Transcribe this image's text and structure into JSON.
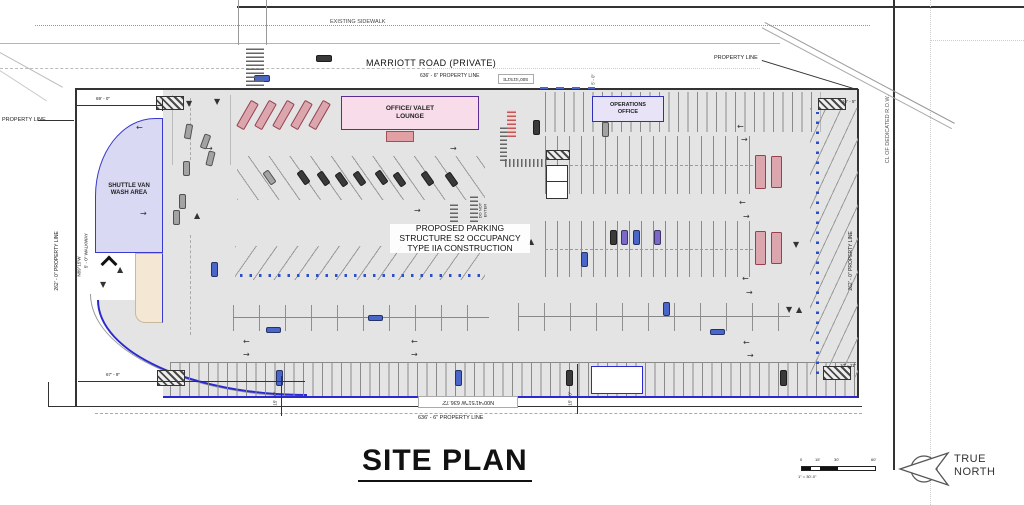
{
  "title": "SITE PLAN",
  "roads": {
    "existing_sidewalk": "EXISTING SIDEWALK",
    "marriott_road": "MARRIOTT ROAD (PRIVATE)"
  },
  "property": {
    "line_label": "PROPERTY LINE",
    "top_dim": "636' - 6\"  PROPERTY LINE",
    "bottom_dim": "636' - 6\"  PROPERTY LINE",
    "left_dim": "262' - 0\" PROPERTY LINE",
    "right_dim": "262' - 0\" PROPERTY LINE",
    "cl_row": "CL OF DEDICATED R.O.W.",
    "bearing_bottom": "N00°41'51\"W 636.72'",
    "bearing_top": "S00°41'51\"E",
    "bearing_left": "N89°15'W",
    "walkway_dim": "5' - 0\" WALKWAY"
  },
  "buildings": {
    "office_valet": "OFFICE/ VALET\nLOUNGE",
    "operations": "OPERATIONS\nOFFICE",
    "wash_area": "SHUTTLE VAN\nWASH AREA"
  },
  "notes": {
    "structure": "PROPOSED PARKING\nSTRUCTURE S2 OCCUPANCY\nTYPE IIA CONSTRUCTION",
    "do_not_enter": "DO NOT\nENTER"
  },
  "dims": {
    "d69": "69' - 0\"",
    "d67": "67' - 9\"",
    "d15_left": "15' - 0\"",
    "d15_right": "15' - 0\"",
    "d10_5": "10' - 5\"",
    "d10_11": "10' - 11\"",
    "d5_0": "5' - 0\""
  },
  "north_arrow": {
    "line1": "TRUE",
    "line2": "NORTH"
  },
  "scale_bar": {
    "tick0": "0",
    "tick1": "15'",
    "tick2": "30'",
    "tick3": "60'",
    "caption": "1\" = 30'-0\""
  },
  "colors": {
    "wash_fill": "#d9d9f3",
    "wash_border": "#3939cf",
    "office_fill": "#f9dcea",
    "office_border": "#5b2d90",
    "ops_fill": "#e9e3f8",
    "ops_border": "#2e2eb8",
    "van_fill": "#dba6ad",
    "accent_blue": "#2b50c8",
    "tan_fill": "#f4e7d4"
  }
}
